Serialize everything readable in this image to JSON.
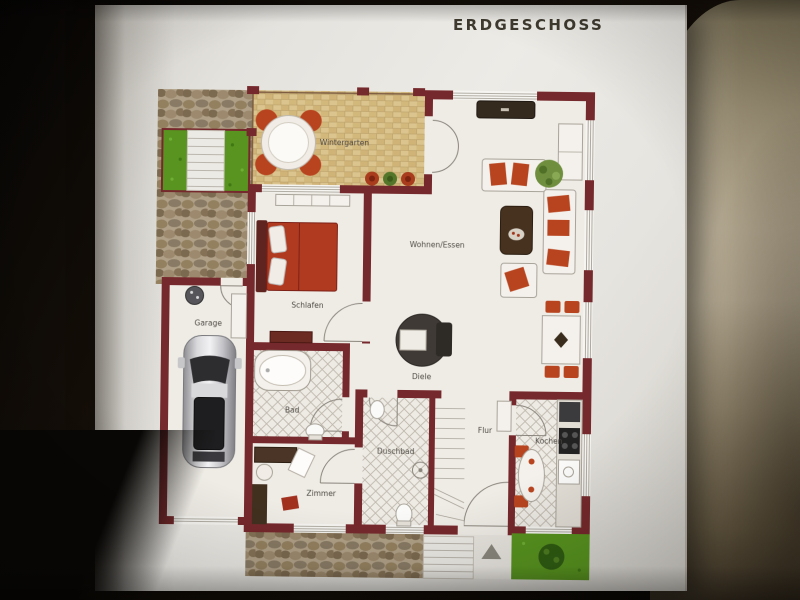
{
  "title": "ERDGESCHOSS",
  "plan": {
    "rooms": {
      "wintergarten": "Wintergarten",
      "wohnen_essen": "Wohnen/Essen",
      "schlafen": "Schlafen",
      "garage": "Garage",
      "bad": "Bad",
      "diele": "Diele",
      "zimmer": "Zimmer",
      "duschbad": "Duschbad",
      "flur": "Flur",
      "kochen": "Kochen"
    },
    "colors": {
      "wall": "#76292c",
      "floor": "#efece6",
      "lawn": "#58941f",
      "red": "#b8441f",
      "stone": "#b0a087",
      "tile": "#dbc48e",
      "page": "#e9e7e2",
      "fabric": "#b3a78d",
      "title_text": "#3e3a2f",
      "label_text": "#4f4a44"
    }
  }
}
